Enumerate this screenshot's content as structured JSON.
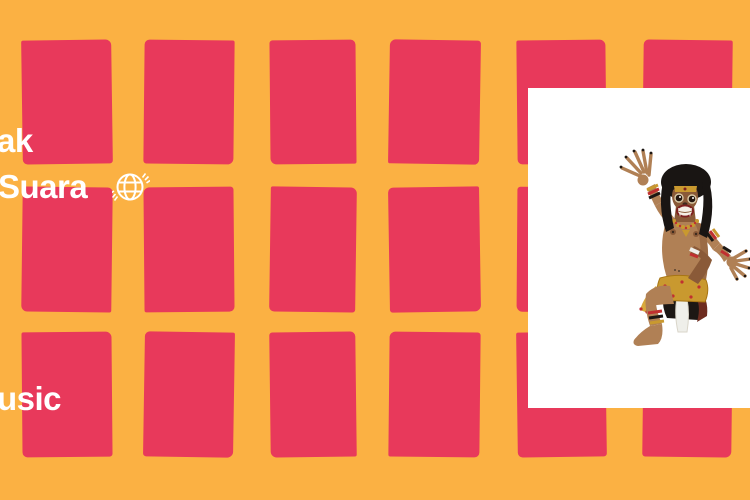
{
  "canvas": {
    "width": 750,
    "height": 500,
    "bg_color": "#FBB143"
  },
  "pattern": {
    "name": "red-rectangle-grid",
    "color": "#E8395B",
    "cols": [
      {
        "x": 22,
        "w": 90
      },
      {
        "x": 144,
        "w": 90
      },
      {
        "x": 270,
        "w": 86
      },
      {
        "x": 389,
        "w": 91
      },
      {
        "x": 517,
        "w": 89
      },
      {
        "x": 643,
        "w": 89
      }
    ],
    "rows": [
      {
        "y": 40,
        "h": 124
      },
      {
        "y": 187,
        "h": 125
      },
      {
        "y": 332,
        "h": 125
      }
    ],
    "tilts": [
      [
        -0.8,
        0.6,
        -0.5,
        0.9,
        -0.6,
        0.7
      ],
      [
        0.7,
        -0.5,
        0.8,
        -0.9,
        0.4,
        -0.6
      ],
      [
        -0.5,
        0.9,
        -0.7,
        0.6,
        -0.8,
        0.7
      ]
    ]
  },
  "overlay_text": {
    "color": "#FFFFFF",
    "line1": "ak",
    "line2": "Suara",
    "line3": "usic"
  },
  "globe_icon": {
    "name": "spinning-globe-icon",
    "color": "#FFFFFF"
  },
  "album_art": {
    "bg_color": "#FFFFFF",
    "subject": "ogoh-ogoh demon figure",
    "colors": {
      "skin": "#B08055",
      "skin_dark": "#8A5A38",
      "hair": "#191513",
      "mouth": "#F4EFE6",
      "lips": "#7E2020",
      "gold": "#C9992F",
      "gold_light": "#D8A93C",
      "red_accent": "#C03030",
      "black": "#1C1714",
      "white_cloth": "#EFEFEA",
      "maroon": "#6E2C20"
    }
  }
}
